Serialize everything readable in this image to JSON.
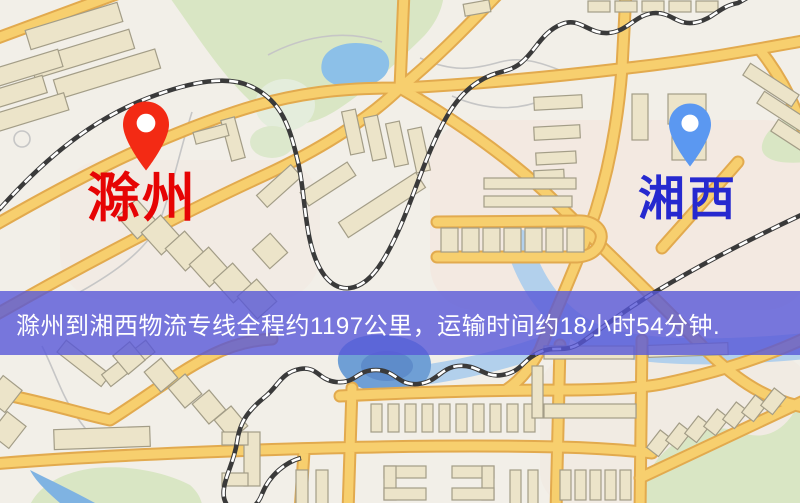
{
  "banner": {
    "text": "滁州到湘西物流专线全程约1197公里，运输时间约18小时54分钟.",
    "distance_km": "1197",
    "duration": "18小时54分钟",
    "bg_color": "#5858d8",
    "text_color": "#ffffff"
  },
  "origin": {
    "name": "滁州",
    "pin_color": "#f32a14",
    "label_color": "#e60404"
  },
  "destination": {
    "name": "湘西",
    "pin_color": "#5b98f1",
    "label_color": "#2629cf"
  },
  "map_palette": {
    "background": "#f2efe8",
    "road_fill": "#f7cf6e",
    "road_edge": "#e2aa4e",
    "park_green": "#d9e6c4",
    "water_blue": "#8cc0e8",
    "lake_deep_blue": "#5e8cca",
    "building_beige": "#ece4c9",
    "railway_dark": "#3a3a3a"
  }
}
